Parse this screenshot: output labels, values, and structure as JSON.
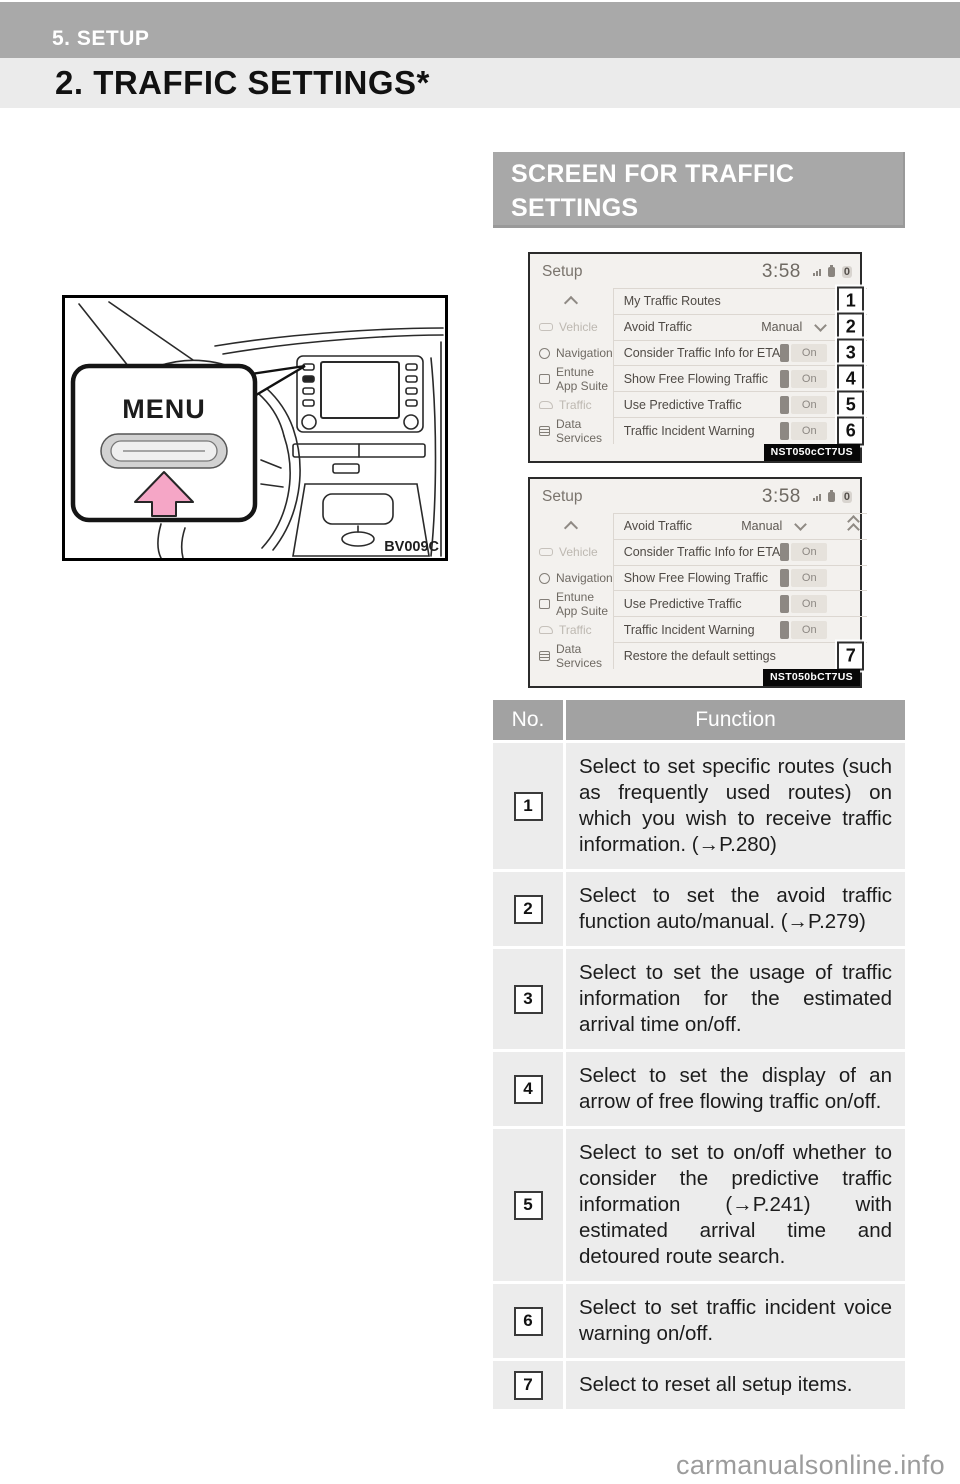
{
  "page": {
    "chapter": "5. SETUP",
    "title": "2. TRAFFIC SETTINGS*",
    "watermark": "carmanualsonline.info"
  },
  "section": {
    "heading_line1": "SCREEN FOR TRAFFIC",
    "heading_line2": "SETTINGS"
  },
  "colors": {
    "band_gray": "#a9a9a9",
    "title_band_gray": "#ebebeb",
    "heading_gray": "#a8a8a8",
    "table_header_gray": "#a2a2a2",
    "row_gray": "#ececec",
    "arrow_pink": "#f5a6c6",
    "screen_bg": "#f3f1ee"
  },
  "illustration": {
    "menu_button": "MENU",
    "figure_code": "BV009C",
    "icons": [
      "steering-wheel",
      "dashboard-display",
      "menu-arrow"
    ]
  },
  "screens": [
    {
      "title": "Setup",
      "clock": "3:58",
      "status_zero": "0",
      "status_icons": [
        "signal-icon",
        "battery-icon",
        "zero-badge"
      ],
      "sidebar": {
        "scroll_up_icon": "chevron-up",
        "items": [
          {
            "label": "Vehicle",
            "faded": true
          },
          {
            "label": "Navigation",
            "faded": false
          },
          {
            "label": "Entune App Suite",
            "faded": false
          },
          {
            "label": "Traffic",
            "faded": true
          },
          {
            "label": "Data Services",
            "faded": false
          }
        ]
      },
      "rows": [
        {
          "label": "My Traffic Routes",
          "control": "plain",
          "callout": "1"
        },
        {
          "label": "Avoid Traffic",
          "control": "dropdown",
          "value": "Manual",
          "callout": "2"
        },
        {
          "label": "Consider Traffic Info for ETA",
          "control": "toggle",
          "value": "On",
          "callout": "3"
        },
        {
          "label": "Show Free Flowing Traffic",
          "control": "toggle",
          "value": "On",
          "callout": "4"
        },
        {
          "label": "Use Predictive Traffic",
          "control": "toggle",
          "value": "On",
          "callout": "5"
        },
        {
          "label": "Traffic Incident Warning",
          "control": "toggle",
          "value": "On",
          "callout": "6"
        }
      ],
      "photo_code": "NST050cCT7US"
    },
    {
      "title": "Setup",
      "clock": "3:58",
      "status_zero": "0",
      "status_icons": [
        "signal-icon",
        "battery-icon",
        "zero-badge"
      ],
      "sidebar": {
        "scroll_up_icon": "chevron-up",
        "items": [
          {
            "label": "Vehicle",
            "faded": true
          },
          {
            "label": "Navigation",
            "faded": false
          },
          {
            "label": "Entune App Suite",
            "faded": false
          },
          {
            "label": "Traffic",
            "faded": true
          },
          {
            "label": "Data Services",
            "faded": false
          }
        ]
      },
      "rows": [
        {
          "label": "Avoid Traffic",
          "control": "dropdown",
          "value": "Manual",
          "collapse_icon": "double-chevron-up"
        },
        {
          "label": "Consider Traffic Info for ETA",
          "control": "toggle",
          "value": "On"
        },
        {
          "label": "Show Free Flowing Traffic",
          "control": "toggle",
          "value": "On"
        },
        {
          "label": "Use Predictive Traffic",
          "control": "toggle",
          "value": "On"
        },
        {
          "label": "Traffic Incident Warning",
          "control": "toggle",
          "value": "On"
        },
        {
          "label": "Restore the default settings",
          "control": "plain",
          "callout": "7"
        }
      ],
      "photo_code": "NST050bCT7US"
    }
  ],
  "table": {
    "headers": {
      "no": "No.",
      "function": "Function"
    },
    "rows": [
      {
        "no": "1",
        "text": "Select to set specific routes (such as frequently used routes) on which you wish to receive traffic information. (→P.280)"
      },
      {
        "no": "2",
        "text": "Select to set the avoid traffic function auto/manual. (→P.279)"
      },
      {
        "no": "3",
        "text": "Select to set the usage of traffic information for the estimated arrival time on/off."
      },
      {
        "no": "4",
        "text": "Select to set the display of an arrow of free flowing traffic on/off."
      },
      {
        "no": "5",
        "text": "Select to set to on/off whether to consider the predictive traffic information (→P.241) with estimated arrival time and detoured route search."
      },
      {
        "no": "6",
        "text": "Select to set traffic incident voice warning on/off."
      },
      {
        "no": "7",
        "text": "Select to reset all setup items."
      }
    ]
  }
}
